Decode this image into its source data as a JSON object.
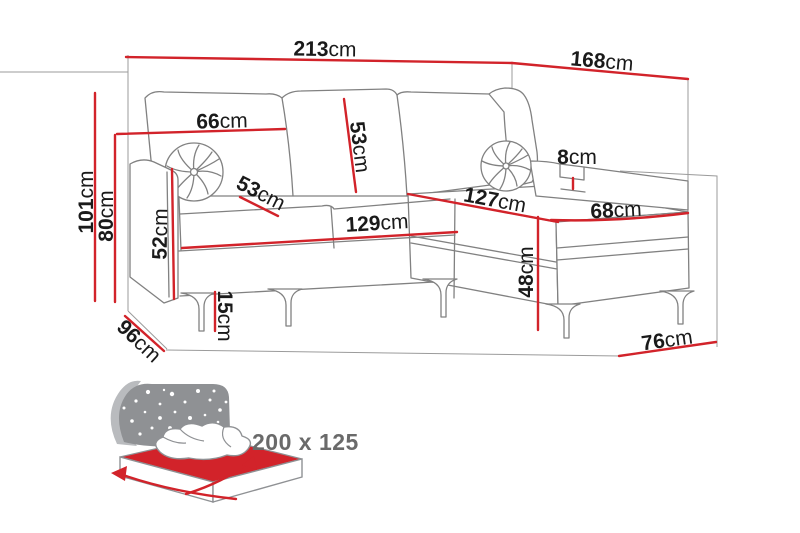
{
  "diagram_title": "corner-sofa-dimension-diagram",
  "colors": {
    "dimension_red": "#d2232a",
    "sketch_gray": "#818181",
    "construction_gray": "#9b9b9b",
    "label_black": "#1a1a1a",
    "icon_gray": "#8f9194",
    "bed_text_gray": "#6a6a6a"
  },
  "dimensions": {
    "back_width": {
      "value": "213",
      "unit": "cm"
    },
    "chaise_back_depth": {
      "value": "168",
      "unit": "cm"
    },
    "total_height": {
      "value": "101",
      "unit": "cm"
    },
    "back_height": {
      "value": "80",
      "unit": "cm"
    },
    "back_cushion_width": {
      "value": "66",
      "unit": "cm"
    },
    "back_cushion_height": {
      "value": "53",
      "unit": "cm"
    },
    "seat_depth": {
      "value": "53",
      "unit": "cm"
    },
    "armrest_height": {
      "value": "52",
      "unit": "cm"
    },
    "seat_width": {
      "value": "129",
      "unit": "cm"
    },
    "leg_height": {
      "value": "15",
      "unit": "cm"
    },
    "side_depth": {
      "value": "96",
      "unit": "cm"
    },
    "chaise_length": {
      "value": "127",
      "unit": "cm"
    },
    "armrest_lip": {
      "value": "8",
      "unit": "cm"
    },
    "chaise_width": {
      "value": "68",
      "unit": "cm"
    },
    "seat_height": {
      "value": "48",
      "unit": "cm"
    },
    "chaise_base_width": {
      "value": "76",
      "unit": "cm"
    }
  },
  "sleeping_area": {
    "label": "200 x 125"
  }
}
